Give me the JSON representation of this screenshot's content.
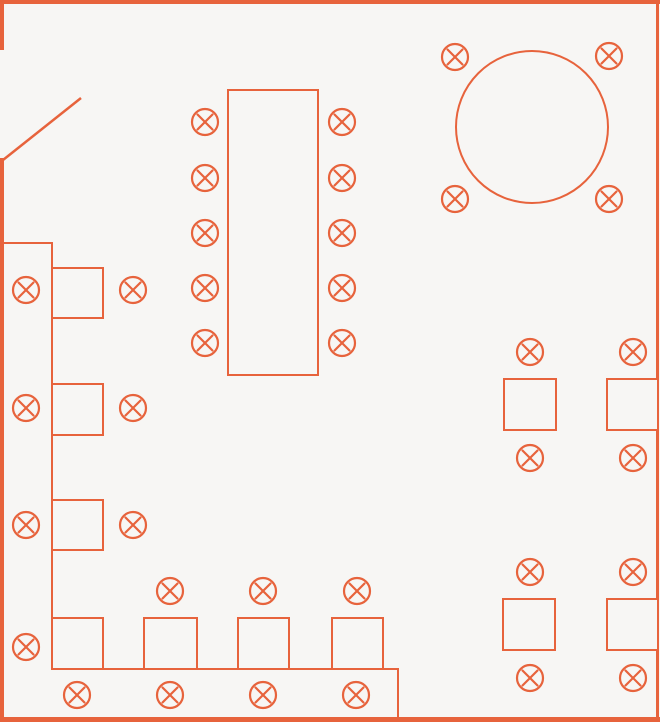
{
  "canvas": {
    "width": 660,
    "height": 722,
    "background_color": "#f7f6f4",
    "stroke_color": "#e7633c"
  },
  "floorplan": {
    "seat_radius": 13,
    "seat_cross_half": 7.5,
    "seat_stroke_width": 2.2,
    "table_stroke_width": 2,
    "door_stroke_width": 2.5,
    "walls": [
      {
        "name": "wall-top",
        "x": 0,
        "y": 0,
        "w": 660,
        "h": 4
      },
      {
        "name": "wall-left-upper",
        "x": 0,
        "y": 0,
        "w": 4,
        "h": 50
      },
      {
        "name": "wall-left-lower",
        "x": 0,
        "y": 158,
        "w": 4,
        "h": 564
      },
      {
        "name": "wall-right",
        "x": 656,
        "y": 0,
        "w": 3,
        "h": 722
      },
      {
        "name": "wall-bottom",
        "x": 0,
        "y": 717,
        "w": 660,
        "h": 5
      },
      {
        "name": "wall-inner-left-horizontal",
        "x": 0,
        "y": 242,
        "w": 53,
        "h": 2
      },
      {
        "name": "wall-inner-left-vertical",
        "x": 51,
        "y": 242,
        "w": 2,
        "h": 377
      },
      {
        "name": "counter-top-edge",
        "x": 52,
        "y": 668,
        "w": 347,
        "h": 2
      },
      {
        "name": "counter-right-edge",
        "x": 397,
        "y": 668,
        "w": 2,
        "h": 49
      }
    ],
    "door": {
      "name": "door-swing-line",
      "x1": 3,
      "y1": 160,
      "x2": 81,
      "y2": 98
    },
    "tables": [
      {
        "name": "table-long",
        "type": "rect",
        "x": 228,
        "y": 90,
        "w": 90,
        "h": 285
      },
      {
        "name": "table-round",
        "type": "circle",
        "cx": 532,
        "cy": 127,
        "r": 76
      },
      {
        "name": "table-left-1",
        "type": "rect",
        "x": 52,
        "y": 268,
        "w": 51,
        "h": 50
      },
      {
        "name": "table-left-2",
        "type": "rect",
        "x": 52,
        "y": 384,
        "w": 51,
        "h": 51
      },
      {
        "name": "table-left-3",
        "type": "rect",
        "x": 52,
        "y": 500,
        "w": 51,
        "h": 50
      },
      {
        "name": "table-corner",
        "type": "rect",
        "x": 52,
        "y": 618,
        "w": 51,
        "h": 51
      },
      {
        "name": "table-bottom-1",
        "type": "rect",
        "x": 144,
        "y": 618,
        "w": 53,
        "h": 51
      },
      {
        "name": "table-bottom-2",
        "type": "rect",
        "x": 238,
        "y": 618,
        "w": 51,
        "h": 51
      },
      {
        "name": "table-bottom-3",
        "type": "rect",
        "x": 332,
        "y": 618,
        "w": 51,
        "h": 51
      },
      {
        "name": "table-right-1",
        "type": "rect",
        "x": 504,
        "y": 379,
        "w": 52,
        "h": 51
      },
      {
        "name": "table-right-2",
        "type": "rect",
        "x": 607,
        "y": 379,
        "w": 51,
        "h": 51
      },
      {
        "name": "table-right-3",
        "type": "rect",
        "x": 503,
        "y": 599,
        "w": 52,
        "h": 51
      },
      {
        "name": "table-right-4",
        "type": "rect",
        "x": 607,
        "y": 599,
        "w": 51,
        "h": 51
      }
    ],
    "seats": [
      {
        "name": "seat-long-left-1",
        "cx": 205,
        "cy": 122
      },
      {
        "name": "seat-long-left-2",
        "cx": 205,
        "cy": 178
      },
      {
        "name": "seat-long-left-3",
        "cx": 205,
        "cy": 233
      },
      {
        "name": "seat-long-left-4",
        "cx": 205,
        "cy": 288
      },
      {
        "name": "seat-long-left-5",
        "cx": 205,
        "cy": 343
      },
      {
        "name": "seat-long-right-1",
        "cx": 342,
        "cy": 122
      },
      {
        "name": "seat-long-right-2",
        "cx": 342,
        "cy": 178
      },
      {
        "name": "seat-long-right-3",
        "cx": 342,
        "cy": 233
      },
      {
        "name": "seat-long-right-4",
        "cx": 342,
        "cy": 288
      },
      {
        "name": "seat-long-right-5",
        "cx": 342,
        "cy": 343
      },
      {
        "name": "seat-round-nw",
        "cx": 455,
        "cy": 57
      },
      {
        "name": "seat-round-ne",
        "cx": 609,
        "cy": 56
      },
      {
        "name": "seat-round-sw",
        "cx": 455,
        "cy": 199
      },
      {
        "name": "seat-round-se",
        "cx": 609,
        "cy": 199
      },
      {
        "name": "seat-left-inner-1",
        "cx": 26,
        "cy": 290
      },
      {
        "name": "seat-left-inner-2",
        "cx": 26,
        "cy": 408
      },
      {
        "name": "seat-left-inner-3",
        "cx": 26,
        "cy": 525
      },
      {
        "name": "seat-left-inner-4",
        "cx": 26,
        "cy": 647
      },
      {
        "name": "seat-left-outer-1",
        "cx": 133,
        "cy": 290
      },
      {
        "name": "seat-left-outer-2",
        "cx": 133,
        "cy": 408
      },
      {
        "name": "seat-left-outer-3",
        "cx": 133,
        "cy": 525
      },
      {
        "name": "seat-bottom-above-1",
        "cx": 170,
        "cy": 591
      },
      {
        "name": "seat-bottom-above-2",
        "cx": 263,
        "cy": 591
      },
      {
        "name": "seat-bottom-above-3",
        "cx": 357,
        "cy": 591
      },
      {
        "name": "seat-bottom-below-1",
        "cx": 77,
        "cy": 695
      },
      {
        "name": "seat-bottom-below-2",
        "cx": 170,
        "cy": 695
      },
      {
        "name": "seat-bottom-below-3",
        "cx": 263,
        "cy": 695
      },
      {
        "name": "seat-bottom-below-4",
        "cx": 356,
        "cy": 695
      },
      {
        "name": "seat-right-1-top",
        "cx": 530,
        "cy": 352
      },
      {
        "name": "seat-right-1-bottom",
        "cx": 530,
        "cy": 458
      },
      {
        "name": "seat-right-2-top",
        "cx": 633,
        "cy": 352
      },
      {
        "name": "seat-right-2-bottom",
        "cx": 633,
        "cy": 458
      },
      {
        "name": "seat-right-3-top",
        "cx": 530,
        "cy": 572
      },
      {
        "name": "seat-right-3-bottom",
        "cx": 530,
        "cy": 678
      },
      {
        "name": "seat-right-4-top",
        "cx": 633,
        "cy": 572
      },
      {
        "name": "seat-right-4-bottom",
        "cx": 633,
        "cy": 678
      }
    ]
  }
}
